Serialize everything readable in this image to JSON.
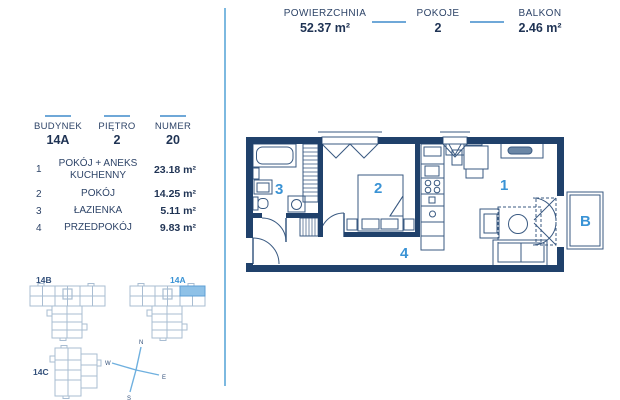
{
  "header": {
    "stats": [
      {
        "label": "POWIERZCHNIA",
        "value": "52.37 m²"
      },
      {
        "label": "POKOJE",
        "value": "2"
      },
      {
        "label": "BALKON",
        "value": "2.46 m²"
      }
    ]
  },
  "unit": {
    "fields": [
      {
        "label": "BUDYNEK",
        "value": "14A"
      },
      {
        "label": "PIĘTRO",
        "value": "2"
      },
      {
        "label": "NUMER",
        "value": "20"
      }
    ]
  },
  "legend": {
    "rows": [
      {
        "no": "1",
        "name": "POKÓJ + ANEKS KUCHENNY",
        "area": "23.18 m²"
      },
      {
        "no": "2",
        "name": "POKÓJ",
        "area": "14.25 m²"
      },
      {
        "no": "3",
        "name": "ŁAZIENKA",
        "area": "5.11 m²"
      },
      {
        "no": "4",
        "name": "PRZEDPOKÓJ",
        "area": "9.83 m²"
      }
    ]
  },
  "site": {
    "buildings": [
      {
        "label": "14B",
        "highlighted": false
      },
      {
        "label": "14A",
        "highlighted": true
      },
      {
        "label": "14C",
        "highlighted": false
      }
    ]
  },
  "compass": {
    "n": "N",
    "e": "E",
    "s": "S",
    "w": "W"
  },
  "plan": {
    "labels": {
      "room1": "1",
      "room2": "2",
      "room3": "3",
      "room4": "4",
      "balcony": "B"
    }
  },
  "colors": {
    "navy_wall": "#20416b",
    "line_navy": "#3a5a82",
    "accent_blue": "#3a93d5",
    "light_blue": "#6fa8d8",
    "site_gray": "#a9bdd2",
    "highlight_fill": "#8ec1e7"
  }
}
